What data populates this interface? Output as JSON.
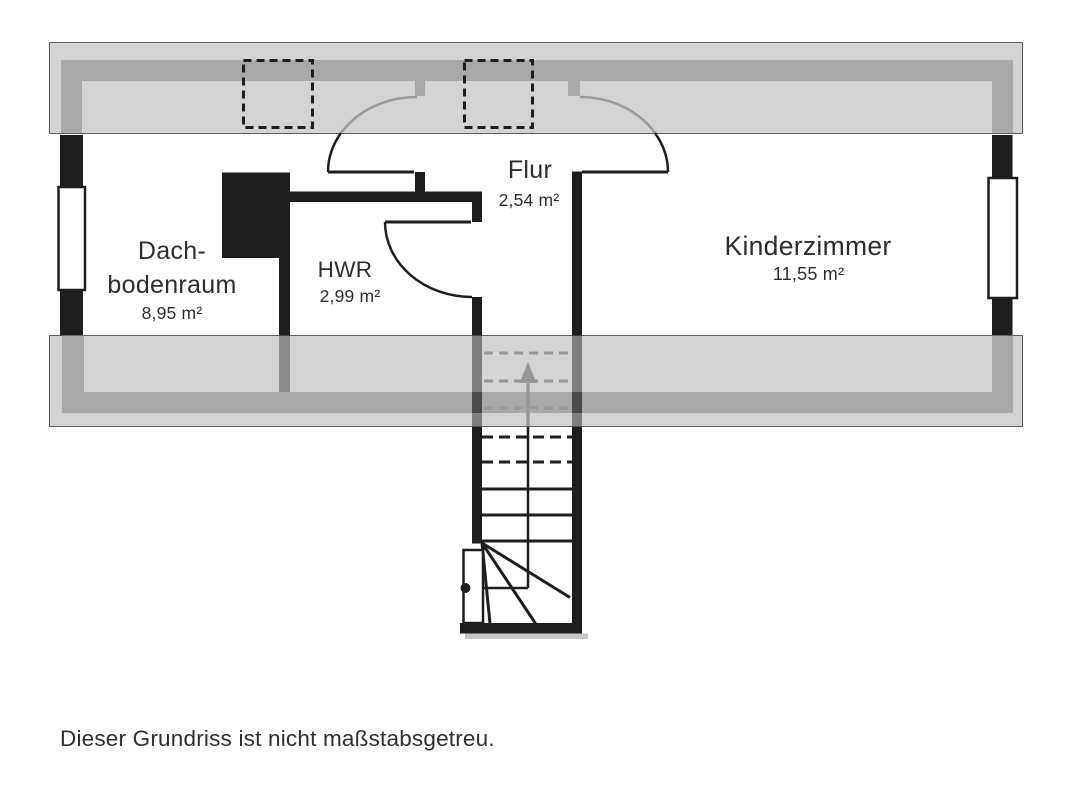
{
  "floorplan": {
    "rooms": {
      "dachbodenraum": {
        "line1": "Dach-",
        "line2": "bodenraum",
        "area": "8,95 m²"
      },
      "hwr": {
        "name": "HWR",
        "area": "2,99 m²"
      },
      "flur": {
        "name": "Flur",
        "area": "2,54 m²"
      },
      "kinderzimmer": {
        "name": "Kinderzimmer",
        "area": "11,55 m²"
      }
    },
    "caption": "Dieser Grundriss ist nicht maßstabsgetreu.",
    "stairs_direction_icon": "up-arrow-icon",
    "skylight_count": 2,
    "colors": {
      "wall": "#1e1e1e",
      "roof_zone": "#d3d3d3",
      "roof_zone_stripe": "#a9a9a9",
      "stair_marks_gray": "#989898",
      "text": "#2d2d2d",
      "background": "#ffffff"
    }
  }
}
